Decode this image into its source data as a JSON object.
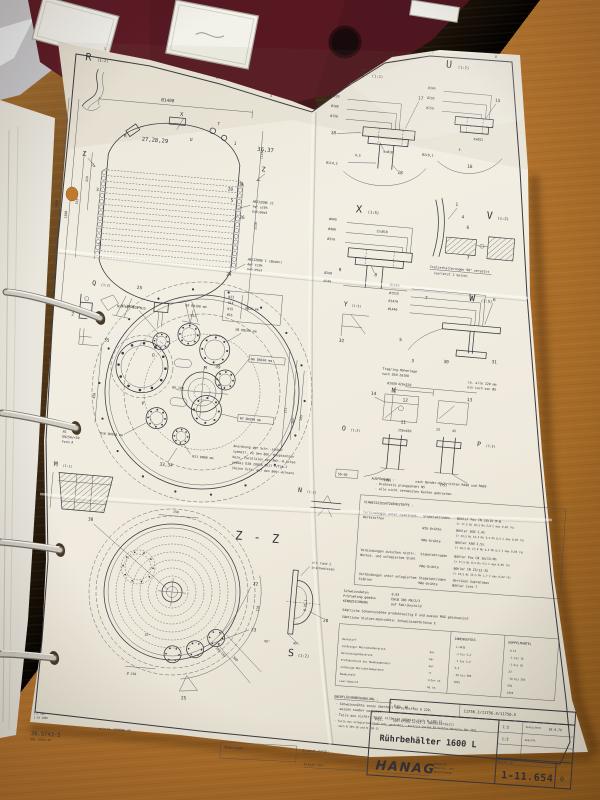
{
  "scene": {
    "desk_color": "#b27030",
    "binder_color": "#571822",
    "paper_color": "#f0ece1",
    "ink_color": "#35343c"
  },
  "grid": {
    "n1": "1",
    "n2": "2",
    "n3": "3",
    "n4": "4",
    "n5": "5",
    "n6": "6",
    "n7": "7",
    "n8": "8"
  },
  "vessel": {
    "dia": "Ø1400",
    "x": "X",
    "t": "T",
    "u": "U",
    "r": "R",
    "g1": "27,28,29",
    "g2": "1",
    "g3": "36,37",
    "zl": "Z",
    "zr": "Z",
    "w": "W",
    "i20": "20",
    "s": "S",
    "i26": "26",
    "i3": "3",
    "q": "Q",
    "i24": "24",
    "i25": "25",
    "n12": "N12",
    "row": "N13 N16  N14  N15",
    "leg1": "N13",
    "leg2": "N14",
    "leg3": "N15",
    "leg4": "N16",
    "legdn": "DN25 mm",
    "h2a": "HEIZZONE II",
    "h2b": "7m² ±10%",
    "h2c": "V=0,06m3",
    "h1a": "HEIZZONE I (Boden)",
    "h1b": "4m² ±10%",
    "h1c": "V=0,05m3",
    "d1": "1500",
    "d2": "1300",
    "d3": "1130",
    "d4": "535",
    "d5": "420",
    "d6": "(135)"
  },
  "flange": {
    "n1a": "N1",
    "n1b": "DN250/+50",
    "n1c": "Form A",
    "n2": "N2 DN50 mm",
    "n3": "N3 DN100 mm",
    "n5": "N5 DN200 mm",
    "n6": "N6 DN100 mm",
    "n7": "N7 DN200 mm",
    "n10": "N10 DN100 mm",
    "n11": "N11 DN80 mm",
    "bg": "BG.100",
    "m": "M",
    "o": "O",
    "p": "P",
    "i35": "35",
    "i39": "39",
    "i33": "33,34",
    "d1": "373",
    "d2": "385",
    "d3": "395",
    "d4": "450",
    "note1": "Anordnung der Schr.-Löcher",
    "note2": "symmetr. zu den Beh.-Hauptachsen",
    "note3": "bezw. Parallelen der Beh.-H.Achse",
    "note4": "gemäss DIN 28036 Teil 2/Tab.2",
    "note5": "(keine Schr. auf den Beh.-Achsen)"
  },
  "zz": {
    "label": "Z - Z",
    "i38": "38",
    "i22": "22",
    "i23": "23",
    "i25": "25",
    "d1": "150",
    "d2": "15°",
    "d3": "45°",
    "d4": "Ø 210",
    "d5": "328",
    "d6": "300",
    "d7": "105/165"
  },
  "det": {
    "t": "T",
    "ts": "(1:2)",
    "td1": "Ø220",
    "td2": "Ø180",
    "td3": "Ø150",
    "ti1": "17",
    "td4": "9xØ18",
    "ti2": "18",
    "td5": "4,5",
    "td6": "Ø114,3",
    "ti3": "18",
    "u": "U",
    "us": "(1:2)",
    "ud1": "Ø340",
    "ud2": "Ø295",
    "ud3": "Ø250",
    "ui1": "15",
    "ud4": "8xØ22",
    "ud5": "5",
    "ud6": "Ø219,1",
    "ui2": "16",
    "x": "X",
    "xs": "(1:5)",
    "xd1": "Ø445",
    "xd2": "Ø400",
    "xd3": "Ø370",
    "xd4": "12xØ18",
    "xd5": "Ø268",
    "xd6": "Ø240",
    "xi1": "9",
    "xi2": "8",
    "v": "V",
    "vs": "(1:2)",
    "vi1": "1",
    "vi2": "4",
    "vi3": "6",
    "vi4": "7",
    "vn1": "Isolierhalterungen 90° versetzt",
    "vn2": "(vorletzt 2 Seite)",
    "w": "W",
    "ws": "(1:5)",
    "wd1": "Ø1650",
    "wd2": "Ø1515",
    "wd3": "Ø1470",
    "wd4": "Ø1440",
    "wi1": "6",
    "wi2": "7",
    "wi3": "5",
    "wi4": "30",
    "wi5": "31",
    "wi6": "32",
    "wi7": "3",
    "wn1": "Tragring-Höhenlage",
    "wn2": "nach DIN 28160",
    "wd5": "Ø1650",
    "wn3": "ca. alle 220 mm",
    "wn4": "ein Loch von Ø5",
    "y": "Y",
    "ys": "(1:5)",
    "q": "Q",
    "qs": "(1:2)",
    "qi1": "2",
    "o": "O",
    "os": "(1:5)",
    "od1": "420x520",
    "oi1": "14",
    "oi2": "12",
    "oi3": "11",
    "on": "N",
    "od2": "250x450",
    "od3": "(78)",
    "p": "P",
    "ps": "(1:5)",
    "pi1": "13",
    "pd1": "(75)",
    "pd2": "25",
    "pd3": "45",
    "n": "N",
    "ns": "(1:2)",
    "s": "S",
    "ss": "(1:2)",
    "si1": "20",
    "sd1": "45°",
    "sd2": "Ø 76,1",
    "sn1": "alt rund 2",
    "sn2": "anschweissen",
    "m": "M",
    "ms": "(1:1)",
    "r": "R",
    "rs": "(1:2)"
  },
  "notes": {
    "stamp": "50-60",
    "aus0": "AUSFÜHRUNG :",
    "aus1": "nach Bender-Nachrichten RA08 und RA09",
    "aus2": "- Drehteile plangedreht N5",
    "aus3": "- alle nicht vermassten Kanten gebrochen",
    "wt": "SCHWEISSZUSATZWERKSTOFFE :",
    "w1a": "Verbindungen unter nichtrost.",
    "w1b": "Werkstoffen",
    "w1k1": "Stabelektroden",
    "w1v1": "Böhler Fox CN 18/16 M-B",
    "w1v1b": "Cr 17,5 Ni 16,5 Mo 2,8   C max 0,05 (%)",
    "w1k2": "WIG-Drähte",
    "w1v2": "Böhler SGN 1,4s",
    "w1v2b": "Cr 19,5 Ni 15,5 Mo 3,5 Mn 6,5 C max 0,04 (%)",
    "w1k3": "MAG-Drähte",
    "w1v3": "Böhler A5N 3,5s",
    "w1v3b": "Cr 18,5 Ni 17,0 Mo 4,5 Mn 6,5 C max 0,03 (%)",
    "w2a": "Verbindungen zwischen nichtr.",
    "w2b": "Werkst. und unlegiertem Stahl",
    "w2k1": "Stabelektroden",
    "w2v1": "Böhler Fox CN 16/13-Mn",
    "w2v1b": "Cr 17,5 Ni 8,5 Mn 4,5   C max 0,09 (%)",
    "w2k2": "MAG-Drähte",
    "w2v2": "Böhler CN 23/12-IG",
    "w2v2b": "Cr 23,5 Ni 13,5 Mn 1,7  C max 0,02 (%)",
    "w3a": "Verbindungen unter unlegiertem",
    "w3b": "Stählen",
    "w3k1": "Stabelektroden",
    "w3v1": "Oerlikon Supranimax",
    "w3k2": "MAG-Drähte",
    "w3v2": "Böhler Coro 7",
    "sd1l": "Schweissdaten",
    "sd1v": "0,93",
    "sd2l": "Prüfumfang gemäss",
    "sd2v": "EHCB 306 PN/2/3",
    "sd3l": "KENNZEICHNUNG",
    "sd3v": "auf Fabrikschild",
    "sn1": "Sämtliche Schweissnähte produktseitig E und aussen MAG geschweisst",
    "sn2": "Sämtliche Stutzen-Rohrnähte: Schweissnahtklasse E",
    "ot": "OBERFLÄCHENBEHANDLUNG :",
    "o1": "- Schweissnähte innen überholt verschliffen K 220,",
    "o1b": "aussen sauber verputzt",
    "o2": "- Teile aus nichtr. Stahl silberig gebeizt  nach N 109-12",
    "o3": "- Teile aus unlegiertem Stahl bds. gestrahlt - Anstrich System B2 Farbton Mausgrau RAL 7005",
    "o3b": "nach N 109-10 und N 109-11"
  },
  "ptable": {
    "c1": "INNENGEFÄSS",
    "c2": "DOPPELMANTEL",
    "r1l": "Werkstoff",
    "r1u": "",
    "r1a": "1.4435",
    "r1b": "H II",
    "r2l": "zulässiger Betriebsüberdruck",
    "r2u": "bar",
    "r2a": "-1 bis 5,2",
    "r2b": "-1 bis 16",
    "r3l": "Berechnungsüberdruck",
    "r3u": "bar",
    "r3a": "-1 bis 5,2",
    "r3b": "-1 bis 16",
    "r4l": "Prüfüberdruck bei Raumtemperatur",
    "r4u": "bar",
    "r4a": "5,5",
    "r4b": "22",
    "r5l": "zulässige Betriebstemperatur",
    "r5u": "°C",
    "r5a": "-10 bis 200",
    "r5b": "-10 bis 250",
    "r6l": "Rauminhalt",
    "r6u": "Liter ca.",
    "r6a": "1625",
    "r6b": "935",
    "r7l": "Leer-Gewicht",
    "r7u": "kg ca.",
    "r7b": "1050"
  },
  "tb": {
    "fabl": "Fab. N. :",
    "fabv": "11756.3/11756.4/11756.5",
    "posl": "Pos.",
    "posv": "505.1/506.1/515.1  (Behälterteil)",
    "title": "Rührbehälter 1600 L",
    "sc1": "1:5",
    "sc2": "1:2",
    "gz": "Gezeichnet",
    "gzv": "28.9.76",
    "gp": "Geprüft",
    "znr": "Zeichn.-Nr.",
    "logo": "HANAG",
    "co1": "Hanag AG",
    "co2": "Apparate- und",
    "co3": "Maschinenbau",
    "num": "1-11.654",
    "rev": "0"
  },
  "foot": {
    "code": "36.5743-5",
    "form": "M.FU.ST. FORMENKL.GM",
    "sub": "RAD. KOPAL.GM",
    "sb1": "1:1  100",
    "sb2": "1:10  1000",
    "ch": "Änderungen",
    "er": "Ersetzt durch:",
    "ef": "Ersatz für:"
  }
}
